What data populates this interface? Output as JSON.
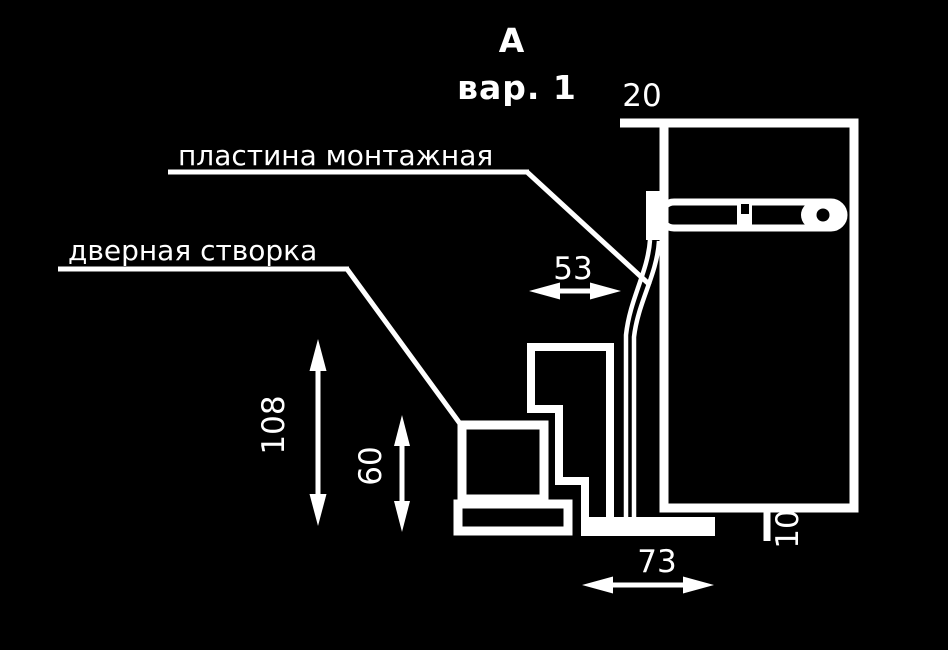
{
  "colors": {
    "background": "#000000",
    "line": "#ffffff"
  },
  "title": {
    "letter": "А",
    "variant": "вар. 1"
  },
  "labels": {
    "mounting_plate": "пластина монтажная",
    "door_leaf": "дверная створка"
  },
  "dimensions": {
    "top_gap": "20",
    "plate_distance": "53",
    "body_height": "108",
    "leaf_height": "60",
    "bottom_width": "73",
    "ledge_thickness": "10"
  }
}
